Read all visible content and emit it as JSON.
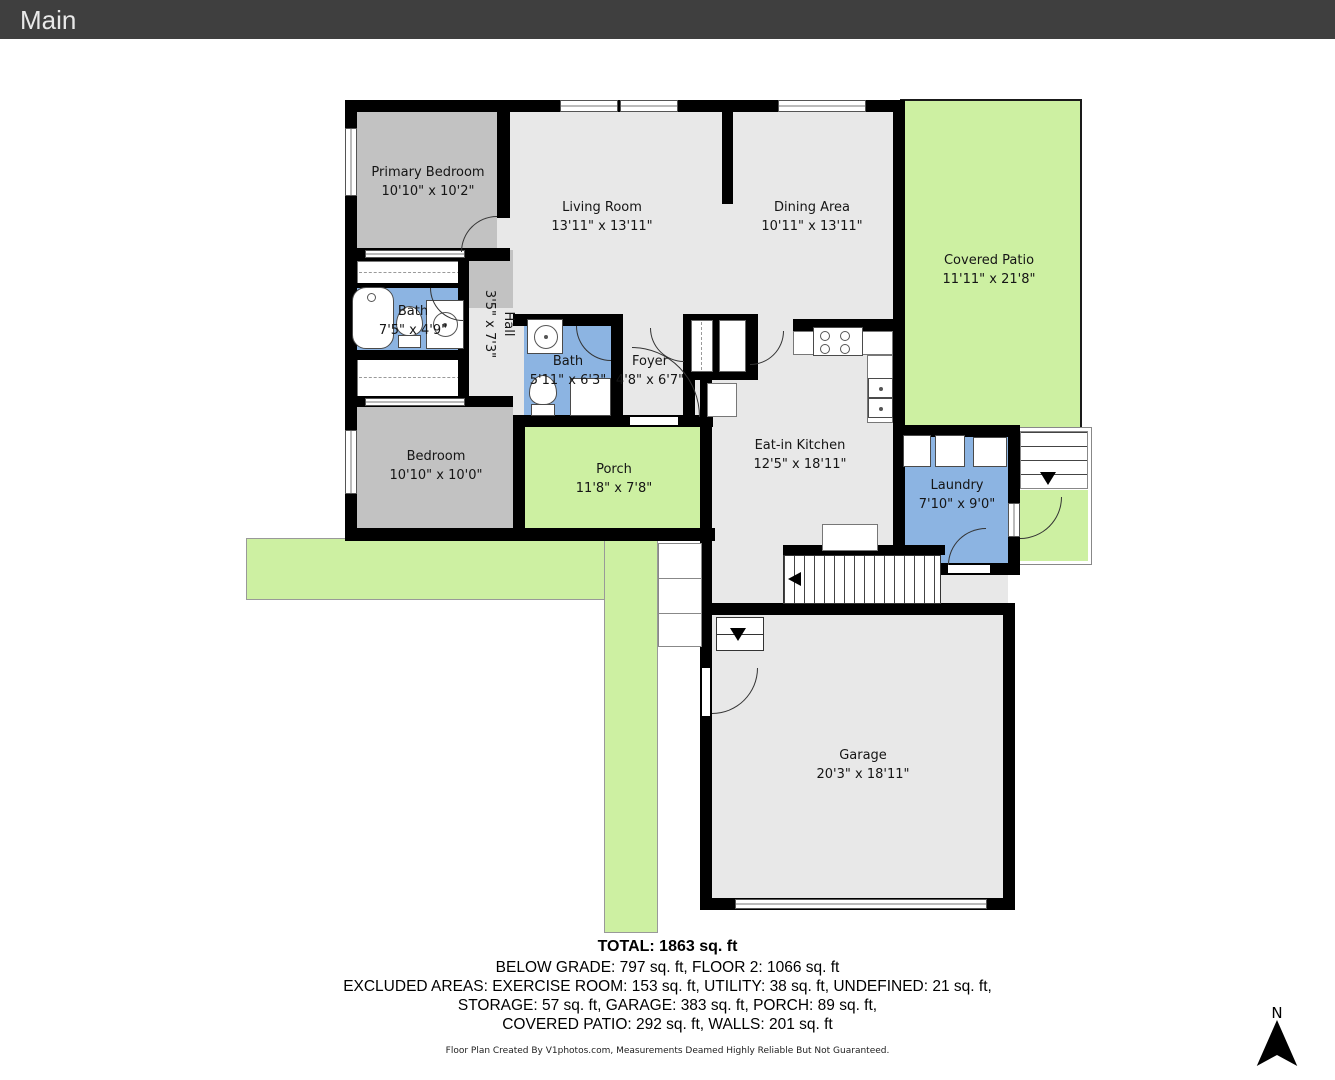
{
  "header": {
    "title": "Main"
  },
  "floorplan": {
    "rooms": [
      {
        "id": "primary-bedroom",
        "name": "Primary Bedroom",
        "dims": "10'10\" x 10'2\""
      },
      {
        "id": "living-room",
        "name": "Living Room",
        "dims": "13'11\" x 13'11\""
      },
      {
        "id": "dining-area",
        "name": "Dining Area",
        "dims": "10'11\" x 13'11\""
      },
      {
        "id": "covered-patio",
        "name": "Covered Patio",
        "dims": "11'11\" x 21'8\""
      },
      {
        "id": "bath-1",
        "name": "Bath",
        "dims": "7'5\" x 4'9\""
      },
      {
        "id": "hall",
        "name": "Hall",
        "dims": "3'5\" x 7'3\""
      },
      {
        "id": "bath-2",
        "name": "Bath",
        "dims": "5'11\" x 6'3\""
      },
      {
        "id": "foyer",
        "name": "Foyer",
        "dims": "4'8\" x 6'7\""
      },
      {
        "id": "eat-in-kitchen",
        "name": "Eat-in Kitchen",
        "dims": "12'5\" x 18'11\""
      },
      {
        "id": "bedroom",
        "name": "Bedroom",
        "dims": "10'10\" x 10'0\""
      },
      {
        "id": "porch",
        "name": "Porch",
        "dims": "11'8\" x 7'8\""
      },
      {
        "id": "laundry",
        "name": "Laundry",
        "dims": "7'10\" x 9'0\""
      },
      {
        "id": "garage",
        "name": "Garage",
        "dims": "20'3\" x 18'11\""
      }
    ],
    "compass": {
      "label": "N"
    }
  },
  "summary": {
    "total": "TOTAL: 1863 sq. ft",
    "grade": "BELOW GRADE: 797 sq. ft, FLOOR 2: 1066 sq. ft",
    "excluded1": "EXCLUDED AREAS: EXERCISE ROOM: 153 sq. ft, UTILITY: 38 sq. ft, UNDEFINED: 21 sq. ft,",
    "excluded2": "STORAGE: 57 sq. ft, GARAGE: 383 sq. ft, PORCH: 89 sq. ft,",
    "excluded3": "COVERED PATIO: 292 sq. ft, WALLS: 201 sq. ft"
  },
  "footer": {
    "credit": "Floor Plan Created By V1photos.com, Measurements Deamed Highly Reliable But Not Guaranteed."
  },
  "colors": {
    "header": "#3f3f3f",
    "wall": "#000000",
    "light": "#e8e8e8",
    "dark": "#c2c2c2",
    "wet": "#8cb4e2",
    "out": "#cdf0a2"
  }
}
